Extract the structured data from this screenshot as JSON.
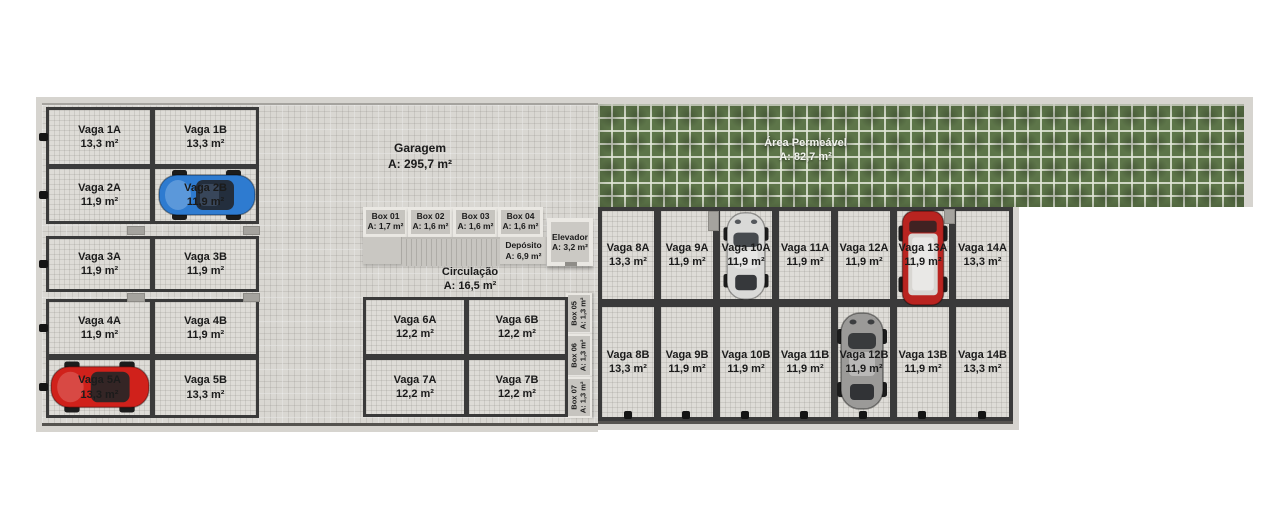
{
  "rooms": {
    "garage": {
      "title": "Garagem",
      "area": "A: 295,7 m²"
    },
    "permeable": {
      "title": "Área Permeável",
      "area": "A: 82,7 m²"
    },
    "circulation": {
      "title": "Circulação",
      "area": "A: 16,5 m²"
    },
    "elevator": {
      "title": "Elevador",
      "area": "A: 3,2 m²"
    },
    "deposit": {
      "title": "Depósito",
      "area": "A: 6,9 m²"
    }
  },
  "boxes": {
    "top": [
      {
        "name": "Box 01",
        "area": "A: 1,7 m²"
      },
      {
        "name": "Box 02",
        "area": "A: 1,6 m²"
      },
      {
        "name": "Box 03",
        "area": "A: 1,6 m²"
      },
      {
        "name": "Box 04",
        "area": "A: 1,6 m²"
      }
    ],
    "side": [
      {
        "name": "Box 05",
        "area": "A: 1,3 m²"
      },
      {
        "name": "Box 06",
        "area": "A: 1,3 m²"
      },
      {
        "name": "Box 07",
        "area": "A: 1,3 m²"
      }
    ]
  },
  "spots": {
    "left": [
      {
        "name": "Vaga 1A",
        "area": "13,3 m²"
      },
      {
        "name": "Vaga 1B",
        "area": "13,3 m²"
      },
      {
        "name": "Vaga 2A",
        "area": "11,9 m²"
      },
      {
        "name": "Vaga 2B",
        "area": "11,9 m²"
      },
      {
        "name": "Vaga 3A",
        "area": "11,9 m²"
      },
      {
        "name": "Vaga 3B",
        "area": "11,9 m²"
      },
      {
        "name": "Vaga 4A",
        "area": "11,9 m²"
      },
      {
        "name": "Vaga 4B",
        "area": "11,9 m²"
      },
      {
        "name": "Vaga 5A",
        "area": "13,3 m²"
      },
      {
        "name": "Vaga 5B",
        "area": "13,3 m²"
      }
    ],
    "mid": [
      {
        "name": "Vaga 6A",
        "area": "12,2 m²"
      },
      {
        "name": "Vaga 6B",
        "area": "12,2 m²"
      },
      {
        "name": "Vaga 7A",
        "area": "12,2 m²"
      },
      {
        "name": "Vaga 7B",
        "area": "12,2 m²"
      }
    ],
    "right_a": [
      {
        "name": "Vaga 8A",
        "area": "13,3 m²"
      },
      {
        "name": "Vaga 9A",
        "area": "11,9 m²"
      },
      {
        "name": "Vaga 10A",
        "area": "11,9 m²"
      },
      {
        "name": "Vaga 11A",
        "area": "11,9 m²"
      },
      {
        "name": "Vaga 12A",
        "area": "11,9 m²"
      },
      {
        "name": "Vaga 13A",
        "area": "11,9 m²"
      },
      {
        "name": "Vaga 14A",
        "area": "13,3 m²"
      }
    ],
    "right_b": [
      {
        "name": "Vaga 8B",
        "area": "13,3 m²"
      },
      {
        "name": "Vaga 9B",
        "area": "11,9 m²"
      },
      {
        "name": "Vaga 10B",
        "area": "11,9 m²"
      },
      {
        "name": "Vaga 11B",
        "area": "11,9 m²"
      },
      {
        "name": "Vaga 12B",
        "area": "11,9 m²"
      },
      {
        "name": "Vaga 13B",
        "area": "11,9 m²"
      },
      {
        "name": "Vaga 14B",
        "area": "13,3 m²"
      }
    ]
  },
  "cars": [
    {
      "spot": "Vaga 2B",
      "description": "blue coupe, parked horizontally"
    },
    {
      "spot": "Vaga 5A",
      "description": "red coupe, parked horizontally"
    },
    {
      "spot": "Vaga 10A",
      "description": "silver coupe, parked vertically"
    },
    {
      "spot": "Vaga 13A",
      "description": "red SUV with light roof, parked vertically"
    },
    {
      "spot": "Vaga 12B",
      "description": "gray car, parked vertically"
    }
  ],
  "colors": {
    "wall": "#3a3a3a",
    "floor": "#d9d7d2",
    "green": "#5d7549",
    "car_blue": "#2e7bd0",
    "car_red": "#d0211b",
    "car_silver": "#d9d9d7",
    "car_suv_red": "#b92420",
    "suv_roof": "#d8d6d2",
    "car_gray": "#9b9a98"
  }
}
